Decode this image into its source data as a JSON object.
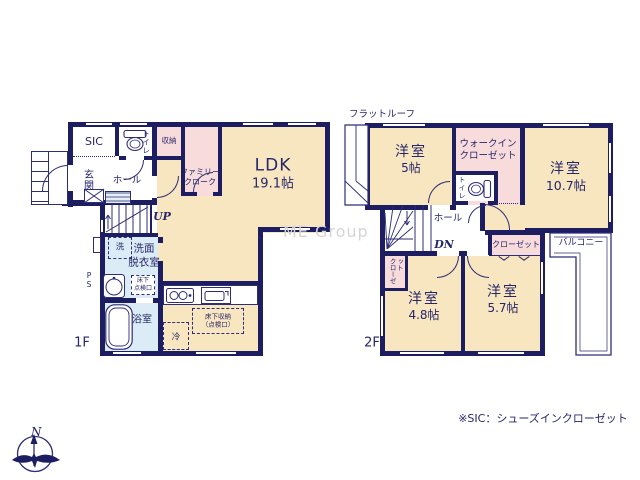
{
  "watermark": "ME Group",
  "footnote": "※SIC：シューズインクローゼット",
  "compass": {
    "north": "N"
  },
  "colors": {
    "wall": "#1d1d62",
    "room_cream": "#f8e6c0",
    "closet_pink": "#f8dbdb",
    "wet_blue": "#dcecf6",
    "watermark": "#d5d5d5"
  },
  "icons": [
    "compass-icon",
    "toilet-icon",
    "bathtub-icon",
    "washbasin-icon",
    "stove-icon",
    "sink-icon",
    "washer-icon"
  ],
  "f1": {
    "floor_label": "1F",
    "sic": "SIC",
    "toilet": "トイレ",
    "storage": "収納",
    "family_cloak_l1": "ファミリー",
    "family_cloak_l2": "クローク",
    "ldk": "LDK",
    "ldk_size": "19.1帖",
    "genkan": "玄関",
    "hall": "ホール",
    "up": "UP",
    "washer": "洗",
    "washroom_l1": "洗面",
    "washroom_l2": "脱衣室",
    "ps": "PS",
    "hatch_l1": "床下",
    "hatch_l2": "点検口",
    "bath": "浴室",
    "fridge": "冷",
    "uf_storage_l1": "床下収納",
    "uf_storage_l2": "（点検口）"
  },
  "f2": {
    "floor_label": "2F",
    "flat_roof": "フラットルーフ",
    "room5": "洋室",
    "room5_size": "5帖",
    "wic_l1": "ウォークイン",
    "wic_l2": "クローゼット",
    "room107": "洋室",
    "room107_size": "10.7帖",
    "toilet": "トイレ",
    "hall": "ホール",
    "dn": "DN",
    "closet_left": "クローゼット",
    "closet_right": "クローゼット",
    "balcony": "バルコニー",
    "room48": "洋室",
    "room48_size": "4.8帖",
    "room57": "洋室",
    "room57_size": "5.7帖"
  }
}
